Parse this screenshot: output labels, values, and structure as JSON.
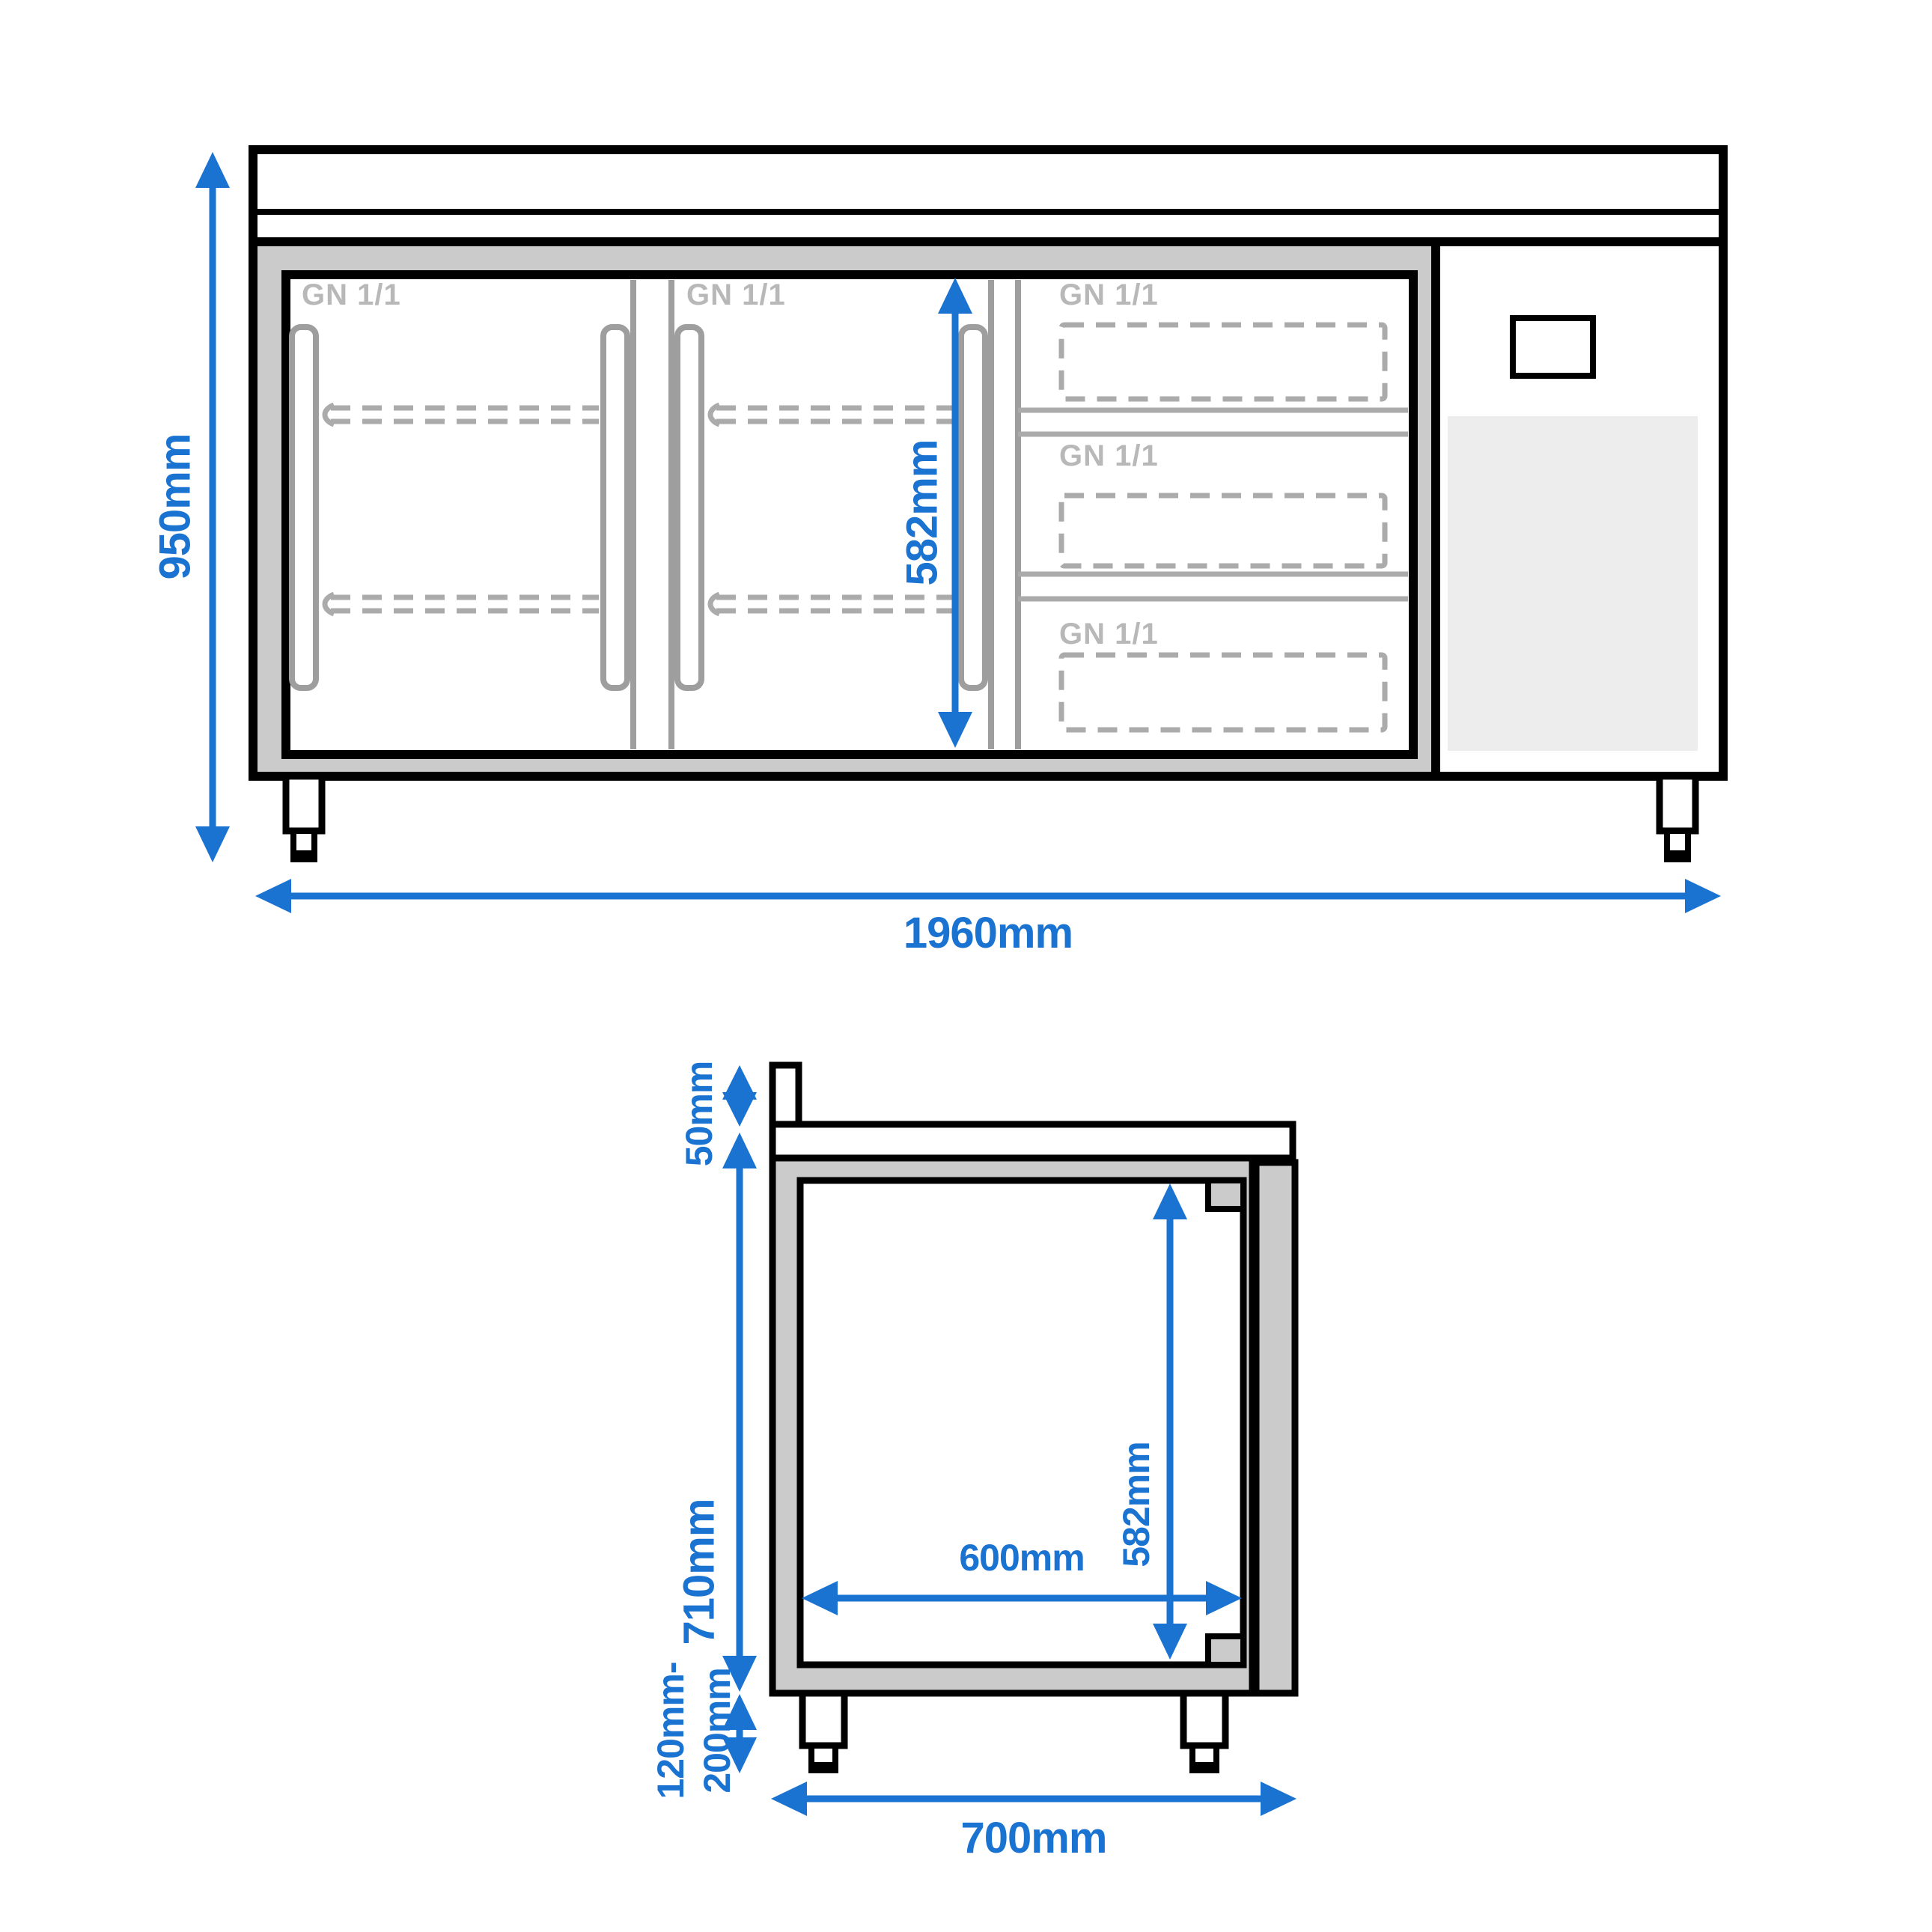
{
  "colors": {
    "blue": "#1a73d1",
    "black": "#000000",
    "frame_gray": "#cbcbcb",
    "line_gray": "#9e9e9e",
    "label_gray": "#b8b8b8",
    "dash_gray": "#ababab",
    "vent_gray": "#ededed",
    "background": "#ffffff"
  },
  "front_view": {
    "dim_height": "950mm",
    "dim_width": "1960mm",
    "dim_inner_height": "582mm",
    "door1_label": "GN 1/1",
    "door2_label": "GN 1/1",
    "drawer1_label": "GN 1/1",
    "drawer2_label": "GN 1/1",
    "drawer3_label": "GN 1/1"
  },
  "side_view": {
    "dim_upstand": "50mm",
    "dim_body_height": "710mm",
    "dim_inner_height": "582mm",
    "dim_inner_depth": "600mm",
    "dim_feet_min": "120mm-",
    "dim_feet_max": "200mm",
    "dim_depth": "700mm"
  }
}
